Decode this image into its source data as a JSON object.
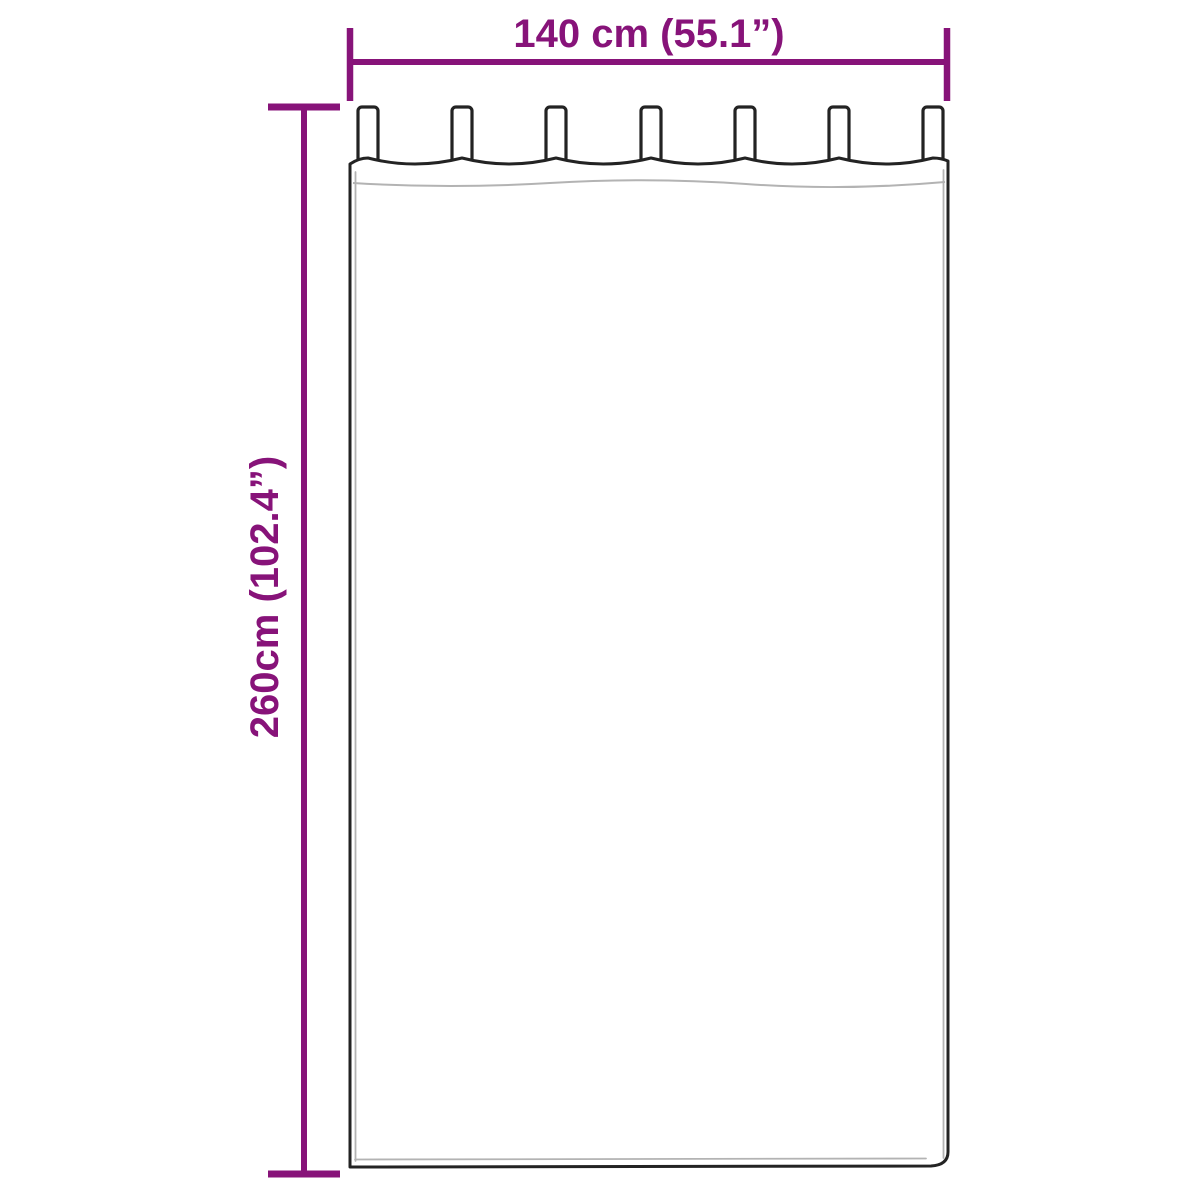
{
  "diagram": {
    "title": "curtain-dimension-diagram",
    "width_label": "140 cm (55.1”)",
    "height_label": "260cm (102.4”)",
    "tab_count": 7
  },
  "colors": {
    "dimension": "#871379",
    "outline": "#232323",
    "seam": "#b3b3b3",
    "panel_fill": "#ffffff",
    "page_bg": "#ffffff"
  }
}
